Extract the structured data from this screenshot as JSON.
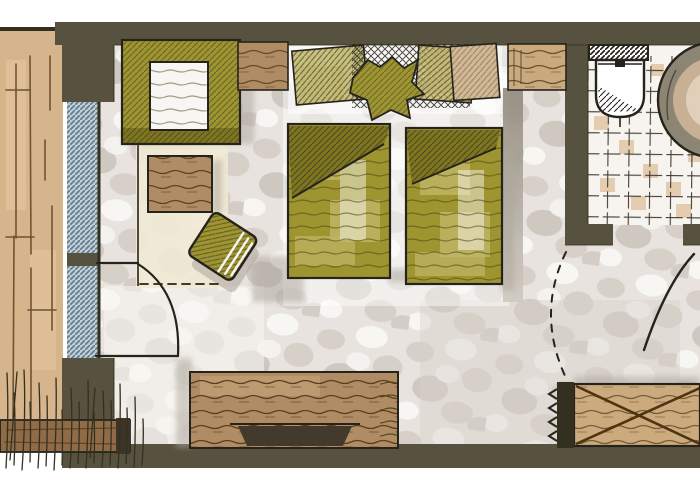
{
  "scene": {
    "kind": "hand-drawn marker floor plan of a hotel room",
    "elements": [
      "balcony-deck",
      "window",
      "balcony-door-swing",
      "armchair",
      "nightstand",
      "coffee-table",
      "rug",
      "ottoman",
      "bed-left",
      "bed-right",
      "pillows",
      "throw-decor",
      "shelf-niche",
      "sideboard",
      "tray",
      "wardrobe",
      "entry-shadow",
      "bathroom",
      "toilet",
      "washbasin",
      "bathroom-door-swing",
      "dashed-door-swing",
      "grass"
    ]
  },
  "palette": {
    "paper": "#ffffff",
    "ink": "#26231c",
    "wall": "#57523f",
    "wallEdge": "#33301f",
    "carpetBase": "#e8e3de",
    "blotchA": "#d6d0c9",
    "blotchB": "#c5beb6",
    "blotchWhite": "#f8f6f3",
    "terrace": "#d6b48c",
    "terraceLight": "#e6c9a4",
    "plank": "#6f5433",
    "windowBlue": "#b7d1e1",
    "olive": "#9e9531",
    "oliveDark": "#7d7520",
    "oliveLight": "#c0b766",
    "oliveSketch": "#45400e",
    "rug": "#f0e9d4",
    "wood": "#b08c65",
    "woodLight": "#c9aa7e",
    "grain": "#573a1b",
    "pillowTan": "#d3b894",
    "trayDark": "#433a2b",
    "tileBase": "#f7f4ef",
    "tileBeige": "#e0c6a6",
    "grid": "#2e2b23",
    "basinOuter": "#8d8574",
    "basinInner": "#c7b094",
    "basinHi": "#e4d5bf",
    "shadow": "#aba49a",
    "corridorShadow": "#8f897c",
    "wardrobeWood": "#cbaa7d",
    "wardrobeX": "#4c3312",
    "barWood": "#8f6c47",
    "barTip": "#3c3526"
  }
}
